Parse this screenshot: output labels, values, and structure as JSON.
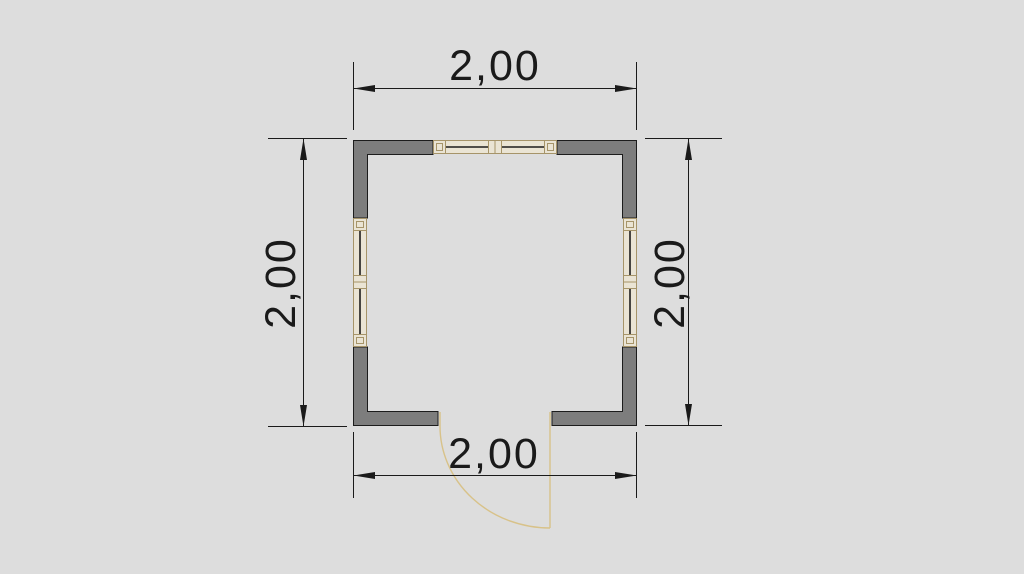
{
  "drawing": {
    "kind": "floor-plan",
    "dimension_labels": {
      "top": "2,00",
      "bottom": "2,00",
      "left": "2,00",
      "right": "2,00"
    },
    "colors": {
      "background": "#dddddd",
      "wall_fill": "#7d7d7d",
      "wall_stroke": "#1c1c1c",
      "window_frame": "#a69469",
      "window_fill": "#eae4d4",
      "door": "#d8c289",
      "dimension": "#1a1a1a"
    }
  }
}
